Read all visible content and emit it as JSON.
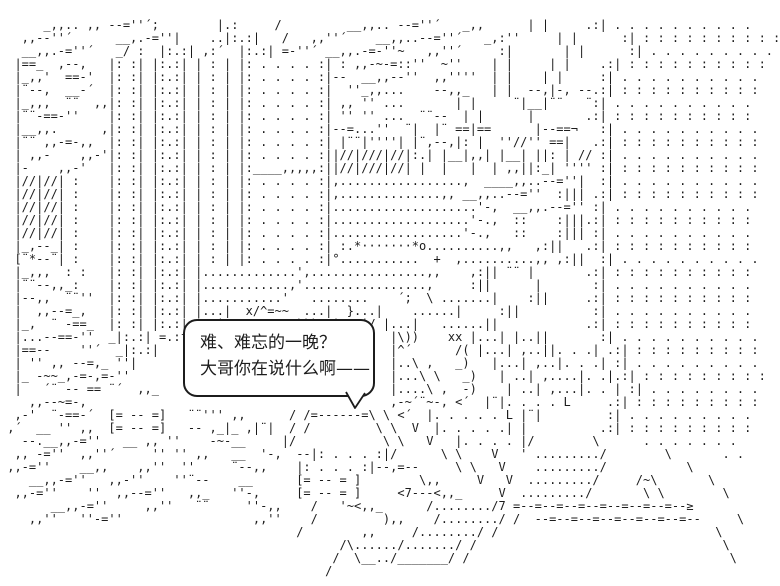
{
  "scene": {
    "colors": {
      "ink": "#1c1c1c",
      "background": "#ffffff"
    },
    "dialogue": {
      "line1": "难、难忘的一晚？",
      "line2": "大哥你在说什么啊——"
    },
    "art": {
      "lines": [
        "",
        "      _,,.. ,, --=''´;        |.:     /         __,,.. --=''´   _,,      | |     .:| . . . . . . . . . .",
        "   ,,--''´      __,.-=''|    ..|:.:|   /   ,,''´    __,,..--=''´   _,:''     | |      :| : : : : : : : : : :",
        "   __,,.-=''´   _/ :  |:.:| ,:´  |:.:| =-''´ __,,.-=-''~   ,,''´     :|       | |      :| . . . . . . . . .",
        "  |==_  ,--,   |: :| |:.:| | : | |: . . . . :| : ,,-~-=::''  ~''    | |     | |    .:| : : : : : : : : : :",
        "  |_,,'  ==-'  |: :| |:.:| | : | |: . . . . :|--  __,,--''  ,,''''  | |    | |     :| . . . . . . . . . .",
        "  |¨--,  __-´  |: :| |:.:| | : | |: . . . . :|  ''_,,...    --,,_   | |  --,|-, --.:| : : : : : : : : : :",
        "  |_,,,  ¨¨  ,,|: :| |:.:| | : | |: . . . . :| ,, '' ...       | |     ¨|__|¨¨   ¨:| . . . . . . . . . .",
        "  |¨¨-==-''    |: :| |:.:| | : | |: . . . . :| '' '' ...  ¨¨--  | |      |       .:| : : : : : : : : : :",
        "  |__,,.      ,|: :| |:.:| | : | |: . . . . :|--=...''  ¨|  |¨ ==|==      |--==¬   :| . . . . . . . . . .",
        "  |¨¨ ,,-=-,,  |: :| |:.:| | : | |: . . . . :| |¨¨|''''| |¨,--,|: |  ''//'' ==|   .:| : : : : : : : : : :",
        "  | ,,-    ,,-'|: :| |:.:| | : | |: . . . . :||//|///|//|:.| |__|,,| |__| ||: | // :| . . . . . . . . . .",
        "  |-    ,,-'   |: :| |:.:| | : | |:____,,,,,:||//|///|//| |  |   |  | ,,||:_| '''' :| : : : : : : : : : :",
        "  |//|//| :    |: :| |:.:| | : | |: . . . . :|,.................,  ____,,..--=''|  :| . . . . . . . . . .",
        "  |//|//| :    |: :| |:.:| | : | |: . . . . :|,..............,, __,,..--=''  :||| .:| : : : : : : : : : :",
        "  |//|//| :    |: :| |:.:| | : | |: . . . . :|....................'-,  __,,.--='' :| . . . . . . . . . .",
        "  |//|//| :    |: :| |:.:| | : | |: . . . . :|...................'-.,  ::    :|||.:| : : : : : : : : : :",
        "  |//|//| :    |: :| |:.:| | : | |: . . . . :|..................'-.,   ::    :||| :| . . . . . . . . . .",
        "  |_,--_| :    |: :| |:.:| | : | |: . . . . :| :.*·······*o..........,,   ,:||   .:| : : : : : : : : : :",
        "  [¨*--¨| :    |: :| |:.:| | : | |: . . . . :|°...........  +  ,..........,, ,:||  :| . . . . . . . . . .",
        "  |_,,,  : :   |: :| |:.:| |.............',................,,    ,:|| ¨¨ |       .:| : : : : : : : : : :",
        "  |¨¨--,,_:    |: :| |:.:| |............,'.................,     :||      |       :| . . . . . . . . . .",
        "  |--,,  ¨¨''  |: :| |:.:| |...........'   ........    ´;  \\ .......|    :||     .:| : : : : : : : : : :",
        "  |  ,,--=_,   |: :| |:.:| |...|  x/^=~~  ...|  }...|    ......|     :||          :| . . . . . . . . . .",
        "  |_,  ¨ -==_  |: :| |:.:| |..| -=~\\    V)))  |...|/ |...|   ......||            .:| : : : : : : : : : :",
        "  |...--==-''  _|:.:| =.:f                            |\\))    xx |...| |..||       :| . . . . . . . . . .",
        "  |==--    ''´  _|:.:|                                |^´      /( |...| ,..||. . .| .:| : : : : : : : : :",
        "  | '' ,, --=,_ ''|                                   |..\\ ,   _)   |...| ,..|. . .| :| . . . . . . . . .",
        "  |_ -~~_,-=-,=-''                                    |...\\ \\   _)   | ..| ,....|. .|.:| : : : : : : : : :",
        "  |   ´¨ -- == ¨´  ,,_                                |....\\ ,  -)    | ..| ,...|. . | :| . . . . . . . .",
        "    ,,--~=-,                                          ,-~´¨~-, <´  |¨|. . . . L     .:| : : : : : : : : :",
        "  ,-'  ¨-==-´  [= -- =]   ¨¨''' ,,      / /=------=\\ \\ <´  |. . . . . L |¨|         :| . . . . . . . . .",
        " ,´  __ '' ,,  [= -- =]   -- ,_|_ ,|¨|  / /         \\ \\  V  |. . . . .| |          .:| : : : : : : : : :",
        "   --.__,,-=''   __ ,, ''    -~-__     |/            \\ \\   V   |. . . . |/        \\      . . . . . . .",
        "  ,, -=''  ,,''´     '' '' ,,   __  '-,  --|: . . . :|/      \\ \\    V   ' ........./        \\       . .",
        " ,,-=''    __,,    ,,''  ''     ¨--,,    |: . . . :|--,=--     \\ \\   V    ........./           \\",
        "    __,,-=''   ,,-''    ''¨--    __      [= -- = ]        \\,,     V   V  ........./     /~\\       \\",
        "  ,,-=''    ''  ,,--=''   ,,_   ''-,     [= -- = ]     <7---<,,_     V  ........./       \\ \\        \\",
        "       __,,-=''     ,,''   ¨¨     ''-,,    /   '~<,,_      /......../7 =--=--=--=--=--=--=--=--≥",
        "    ,,''   ''-=''                  ,,''    /         ),,    /......../ /  --=--=--=--=--=--=--=--     \\",
        "                                         /        ,,     /......../ /                              \\",
        "                                               /\\....../......./ /                                  \\",
        "                                              /  \\__../_______/ /                                    \\",
        "                                             /"
      ]
    }
  }
}
